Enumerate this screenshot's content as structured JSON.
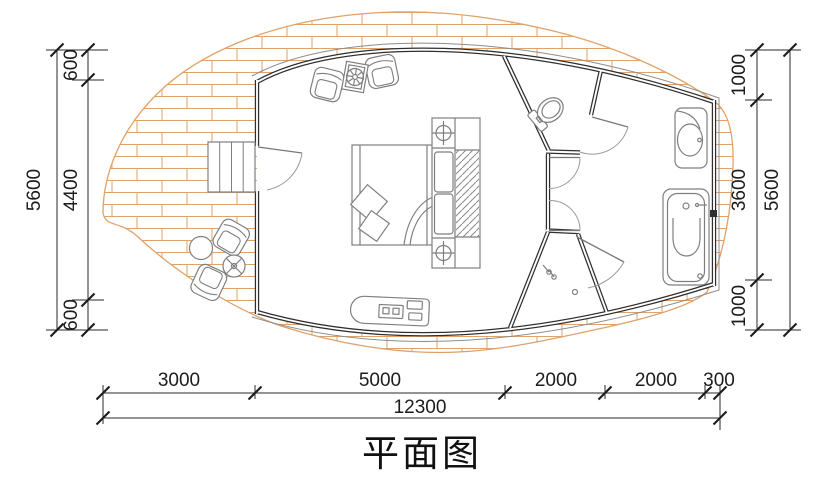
{
  "title": "平面图",
  "colors": {
    "brick_line": "#dfa26a",
    "wall": "#2f2f2f",
    "furniture_line": "#7f7f7f",
    "dimension_line": "#2a2a2a",
    "background": "#ffffff"
  },
  "dimensions": {
    "left_outer_total": "5600",
    "left": [
      "600",
      "4400",
      "600"
    ],
    "right": [
      "1000",
      "3600",
      "1000"
    ],
    "right_outer_total": "5600",
    "bottom": [
      "3000",
      "5000",
      "2000",
      "2000",
      "300"
    ],
    "bottom_total": "12300"
  }
}
